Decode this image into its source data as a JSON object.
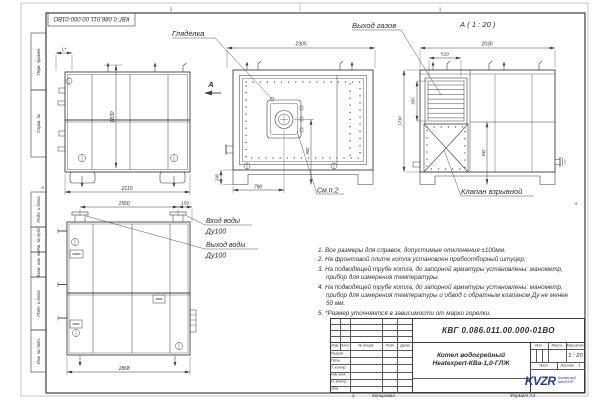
{
  "sheet": {
    "doc_number": "КВГ 0.086.011.00.000-01ВО",
    "zone_2": "2",
    "zone_1": "1",
    "fold_letter": "А",
    "copy_num": "1",
    "copy_label": "Копировал",
    "format_label": "Формат А3"
  },
  "margin_columns": [
    "Перв. примен.",
    "Справ. №",
    "Подп. и дата",
    "Инв. № дубл.",
    "Взам. инв. №",
    "Подп. и дата",
    "Инв. № подл."
  ],
  "views": {
    "side_left": {
      "dim_l": "L*",
      "dim_height": "1830",
      "dim_width": "2110"
    },
    "front": {
      "label_sight_glass": "Гляделка",
      "view_arrow_label": "А",
      "dim_width": "2305",
      "dim_base": "790",
      "dim_base_height": "290",
      "dim_burner_axis": "950",
      "see_note": "См.п.2"
    },
    "view_a": {
      "title": "А ( 1 : 20 )",
      "label_gas_outlet": "Выход газов",
      "label_explosion_valve": "Клапан взрывной",
      "dim_width": "2030",
      "dim_vent_width": "510",
      "dim_vent_height": "600",
      "dim_height": "1730",
      "dim_mid_height": "940"
    },
    "side_bottom": {
      "dim_pipe_span": "1550",
      "dim_pipe_edge": "159",
      "dim_width": "1868",
      "label_water_in": "Вход воды",
      "label_water_in_dn": "Ду100",
      "label_water_out": "Выход воды",
      "label_water_out_dn": "Ду100"
    }
  },
  "notes": [
    "1. Все размеры для справок, допустимые отклонения ±100мм.",
    "2. На фронтовой плите котла установлен пробоотборный штуцер.",
    "3. На подводящей трубе котла, до запорной арматуры установлены: манометр, прибор для измерения температуры.",
    "4. На подводящей трубе котла, до запорной арматуры установлены: манометр, прибор для измерения температуры и обвод с обратным клапаном Ду не менее 50 мм.",
    "5. *Размер уточняется в зависимости от марки горелки."
  ],
  "title_block": {
    "doc_number": "КВГ 0.086.011.00.000-01ВО",
    "name_line1": "Котел водогрейный",
    "name_line2": "Heatexpert-КВа-1,0-ГЛЖ",
    "col_headers": [
      "Изм.",
      "Лист",
      "№ докум.",
      "Подп.",
      "Дата"
    ],
    "row_labels": [
      "Разраб.",
      "Пров.",
      "Т. контр.",
      "Нач.отд.",
      "Н. контр.",
      "Утв."
    ],
    "lit_label": "Лит.",
    "mass_label": "Масса",
    "scale_label": "Масштаб",
    "scale_value": "1 : 20",
    "sheet_label": "Лист",
    "sheets_label": "Листов",
    "sheets_value": "1",
    "logo_text": "KVZR",
    "company_line1": "Котельный",
    "company_line2": "завод КЗР",
    "accent_color": "#2b3a8f"
  }
}
